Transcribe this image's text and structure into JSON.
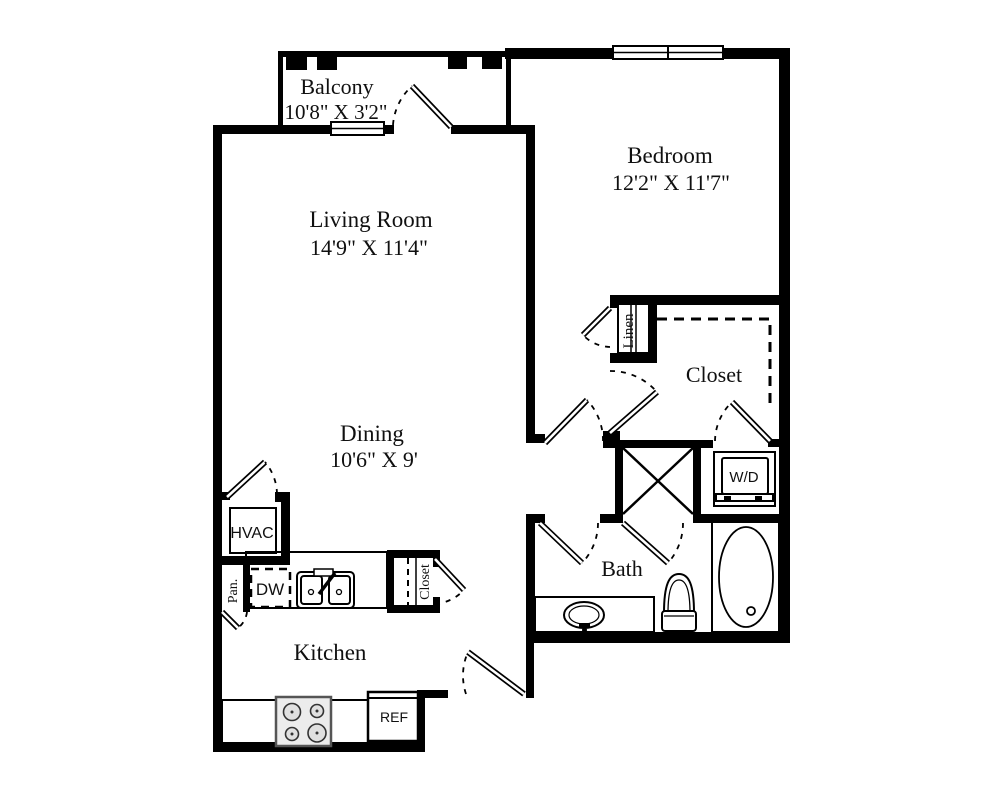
{
  "floorplan": {
    "rooms": {
      "balcony": {
        "name": "Balcony",
        "dims": "10'8\" X 3'2\""
      },
      "living_room": {
        "name": "Living Room",
        "dims": "14'9\" X 11'4\""
      },
      "bedroom": {
        "name": "Bedroom",
        "dims": "12'2\" X 11'7\""
      },
      "dining": {
        "name": "Dining",
        "dims": "10'6\" X 9'"
      },
      "walk_in_closet": {
        "name": "Closet"
      },
      "linen_closet": {
        "name": "Linen"
      },
      "bath": {
        "name": "Bath"
      },
      "kitchen": {
        "name": "Kitchen"
      }
    },
    "fixtures": {
      "hvac": "HVAC",
      "dishwasher": "DW",
      "pantry": "Pan.",
      "kitchen_closet": "Closet",
      "washer_dryer": "W/D",
      "refrigerator": "REF"
    },
    "colors": {
      "walls": "#000000",
      "background": "#ffffff"
    }
  }
}
